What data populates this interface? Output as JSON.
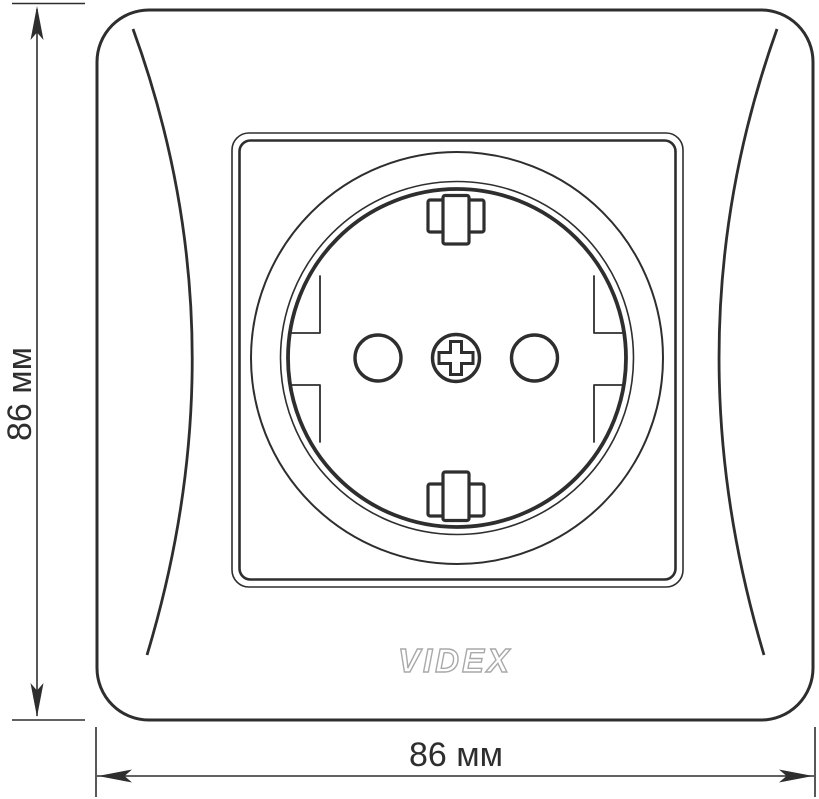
{
  "dimensions": {
    "height": {
      "label": "86 мм"
    },
    "width": {
      "label": "86 мм"
    }
  },
  "brand": {
    "logo_text": "VIDEX",
    "logo_color": "#a9a9a9"
  },
  "colors": {
    "line": "#2e2e2e",
    "background": "#ffffff"
  }
}
